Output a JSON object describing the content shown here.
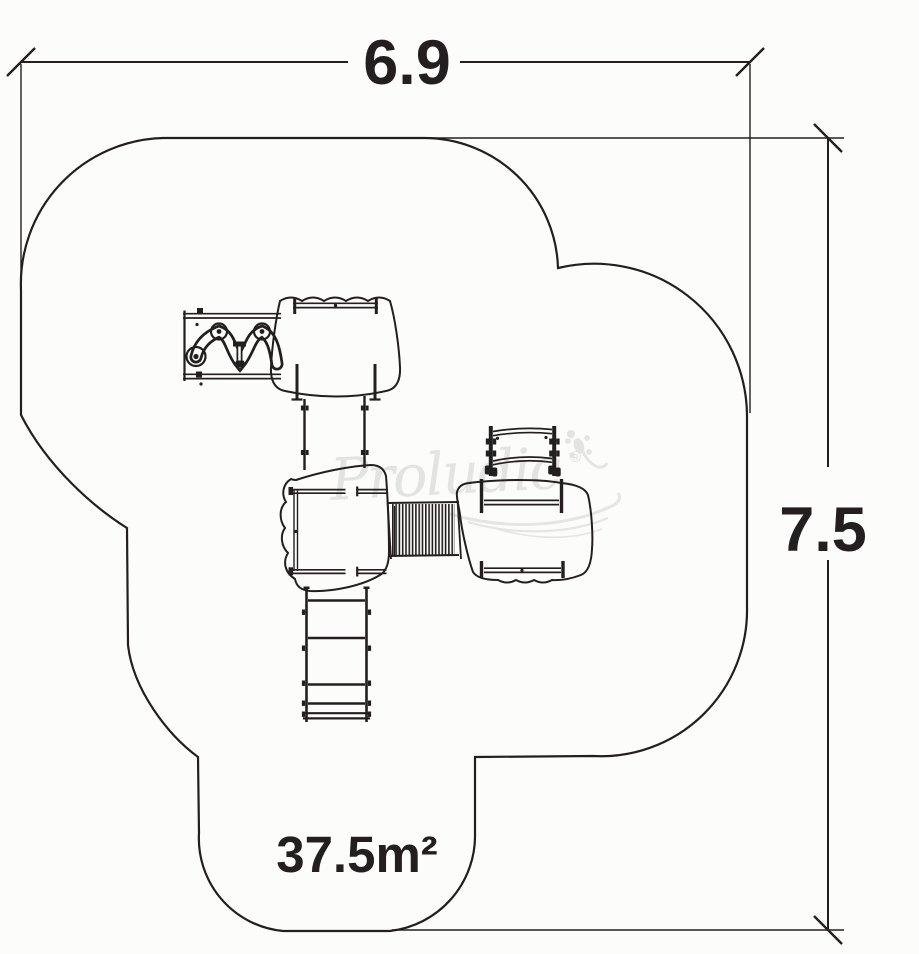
{
  "dimensions": {
    "width": "6.9",
    "height": "7.5",
    "area": "37.5m²"
  },
  "watermark": {
    "brand": "Proludic",
    "registered": "®"
  },
  "colors": {
    "line": "#231f20",
    "watermark": "#e3e3e1",
    "background": "#fcfcfb"
  }
}
